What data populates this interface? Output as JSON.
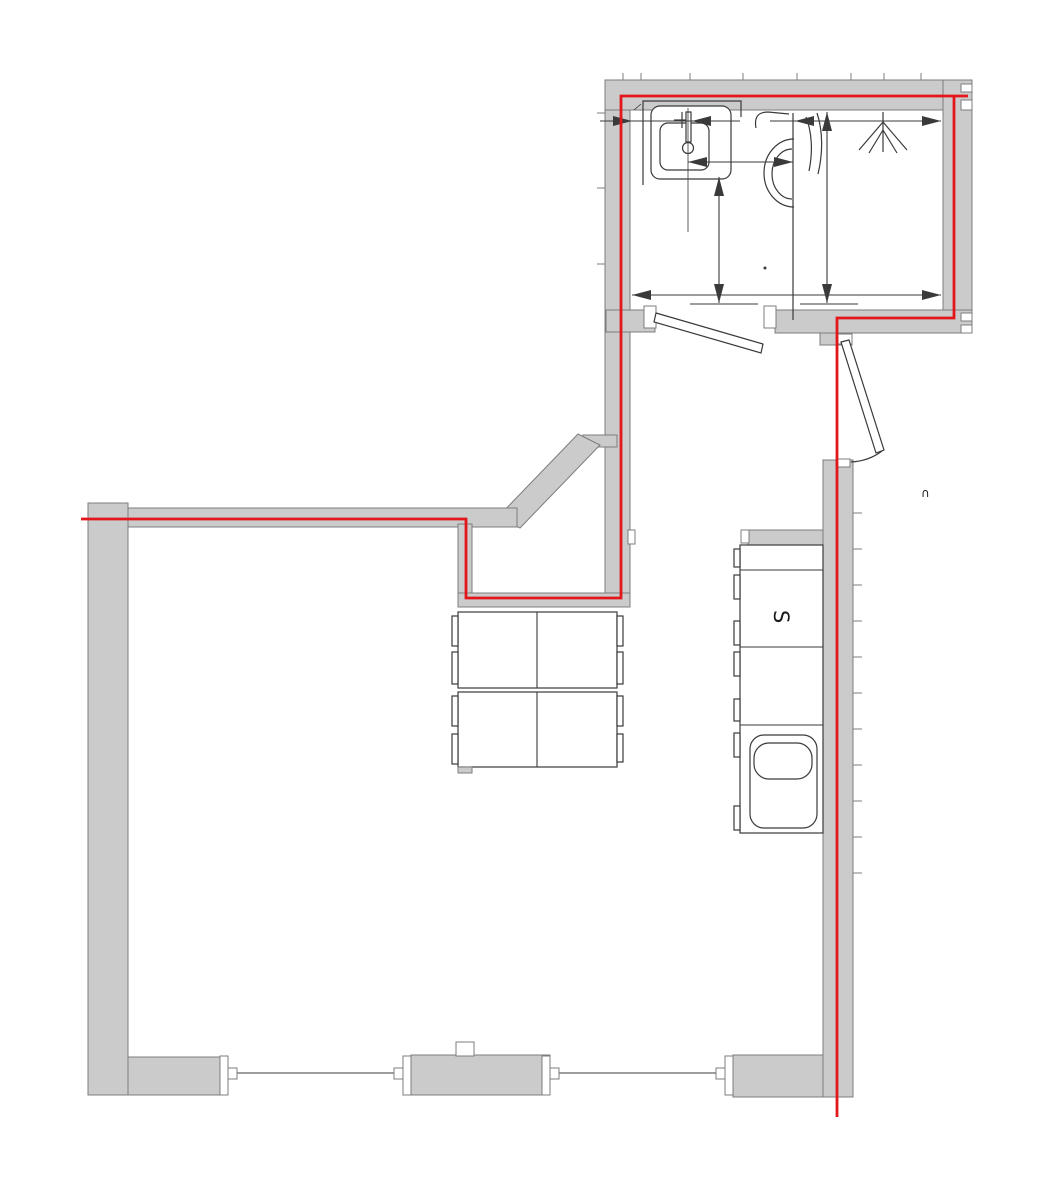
{
  "labels": {
    "appliance": "S",
    "arc_mark": "∩"
  },
  "colors": {
    "background": "#ffffff",
    "wall_fill": "#cbcbcb",
    "wall_stroke": "#7d7d7d",
    "line": "#3a3a3a",
    "highlight": "#e3161c"
  }
}
